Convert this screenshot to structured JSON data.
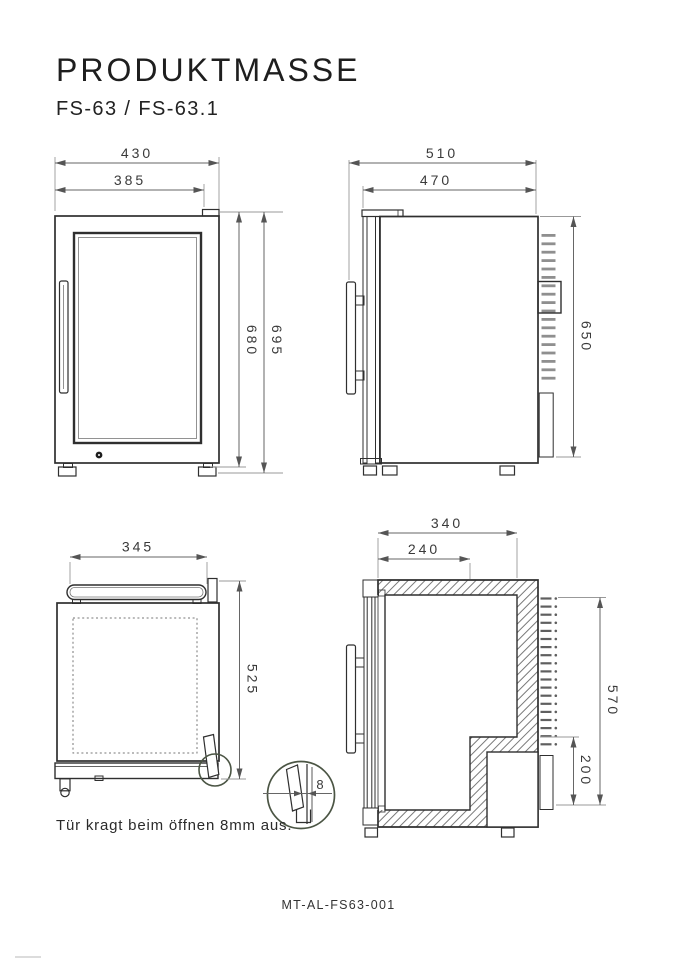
{
  "title": "PRODUKTMASSE",
  "subtitle": "FS-63 / FS-63.1",
  "note": "Tür kragt beim öffnen 8mm aus.",
  "doc_code": "MT-AL-FS63-001",
  "front_view": {
    "width_total": "430",
    "width_door": "385",
    "height_body": "680",
    "height_total": "695"
  },
  "side_view": {
    "depth_total": "510",
    "depth_body": "470",
    "height_body": "650"
  },
  "top_view": {
    "width_handle": "345",
    "depth_body": "525"
  },
  "section_view": {
    "depth_top": "340",
    "depth_bottom": "240",
    "height_interior": "570",
    "height_compressor": "200"
  },
  "detail": {
    "overhang": "8"
  },
  "colors": {
    "line": "#2f2f2f",
    "dimension": "#666666",
    "detail_circle": "#4b5544",
    "vent_slot": "#8f8f8f"
  }
}
